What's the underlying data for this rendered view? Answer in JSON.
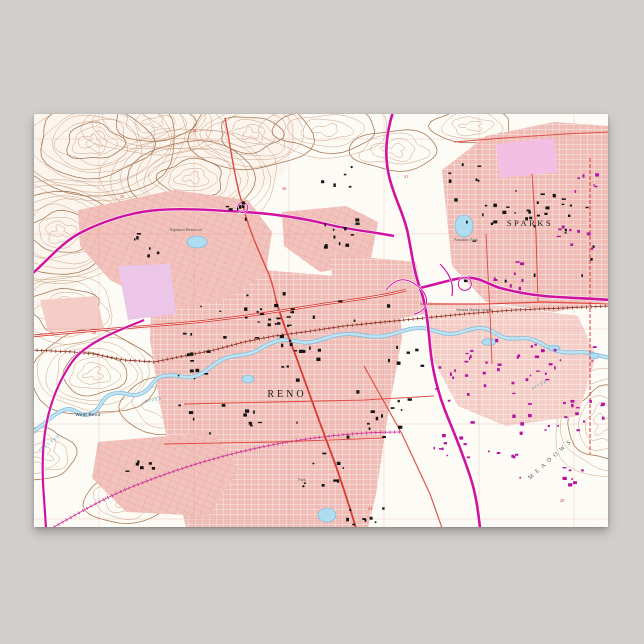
{
  "scene": {
    "background_color": "#d1cfcc",
    "poster_paper_color": "#fdfbf6"
  },
  "palette": {
    "contour": "#c59877",
    "contour_dark": "#a87b58",
    "terrain_wash": "#f9f1e7",
    "urban_pink": "#efbcb6",
    "urban_pink_light": "#f4cdc6",
    "lavender": "#ecc6e8",
    "lavender2": "#f4bfe4",
    "highway_magenta": "#cf12a0",
    "road_red": "#df4a42",
    "road_red_bold": "#d93a32",
    "rail_brown": "#8a2a1e",
    "rail_magenta": "#cc2a96",
    "water_edge": "#7db9d9",
    "water_fill": "#bfe3f2",
    "pond_fill": "#aedcf0",
    "pond_edge": "#74b4d4",
    "building_black": "#141414",
    "building_purple": "#b016a0",
    "section_line_red": "#e89088",
    "section_number_red": "#e03030",
    "label_black": "#1a1a1a",
    "label_gray": "#555555",
    "label_blue": "#4aa0c8"
  },
  "map": {
    "labels": [
      {
        "id": "reno",
        "text": "RENO",
        "x": 253,
        "y": 283,
        "size": 10,
        "spacing": 3,
        "fill": "#1a1a1a",
        "font": "serif",
        "rotate": 0,
        "italic": false
      },
      {
        "id": "sparks",
        "text": "SPARKS",
        "x": 496,
        "y": 112,
        "size": 8.5,
        "spacing": 2.5,
        "fill": "#1a1a1a",
        "font": "serif",
        "rotate": 0,
        "italic": false
      },
      {
        "id": "west-reno",
        "text": "West Reno",
        "x": 54,
        "y": 302,
        "size": 4.5,
        "spacing": 0.3,
        "fill": "#222222",
        "font": "sans",
        "rotate": 0,
        "italic": false
      },
      {
        "id": "meadows",
        "text": "MEADOWS",
        "x": 518,
        "y": 346,
        "size": 6,
        "spacing": 4,
        "fill": "#555555",
        "font": "serif",
        "rotate": -42,
        "italic": false
      },
      {
        "id": "truckee-river-w",
        "text": "TRUCKEE",
        "x": 16,
        "y": 330,
        "size": 4,
        "spacing": 1.2,
        "fill": "#4aa0c8",
        "font": "serif",
        "rotate": -38,
        "italic": true
      },
      {
        "id": "river-w",
        "text": "RIVER",
        "x": 120,
        "y": 287,
        "size": 4,
        "spacing": 1.2,
        "fill": "#4aa0c8",
        "font": "serif",
        "rotate": -12,
        "italic": true
      },
      {
        "id": "river-e",
        "text": "RIVER",
        "x": 506,
        "y": 272,
        "size": 4,
        "spacing": 1.2,
        "fill": "#4aa0c8",
        "font": "serif",
        "rotate": -28,
        "italic": true
      },
      {
        "id": "highland-reservoir",
        "text": "Highland Reservoir",
        "x": 152,
        "y": 117,
        "size": 3.4,
        "spacing": 0.2,
        "fill": "#444444",
        "font": "sans",
        "rotate": 0,
        "italic": false
      },
      {
        "id": "paradise-park",
        "text": "Paradise Park",
        "x": 432,
        "y": 127,
        "size": 3.4,
        "spacing": 0.2,
        "fill": "#444444",
        "font": "sans",
        "rotate": 0,
        "italic": false
      },
      {
        "id": "nevada-mental-health",
        "text": "Nevada Mental Health",
        "x": 440,
        "y": 197,
        "size": 3.2,
        "spacing": 0.2,
        "fill": "#444444",
        "font": "sans",
        "rotate": 0,
        "italic": false
      },
      {
        "id": "park",
        "text": "Park",
        "x": 268,
        "y": 367,
        "size": 3.4,
        "spacing": 0.2,
        "fill": "#444444",
        "font": "sans",
        "rotate": 0,
        "italic": false
      }
    ],
    "section_numbers": [
      {
        "text": "35",
        "x": 88,
        "y": 84
      },
      {
        "text": "36",
        "x": 250,
        "y": 76
      },
      {
        "text": "31",
        "x": 372,
        "y": 64
      },
      {
        "text": "30",
        "x": 160,
        "y": 18
      },
      {
        "text": "28",
        "x": 60,
        "y": 220
      },
      {
        "text": "24",
        "x": 336,
        "y": 396
      },
      {
        "text": "20",
        "x": 528,
        "y": 388
      }
    ],
    "terrain_wash_path": "M 0,0 L 270,0 L 250,60 L 200,90 L 120,110 L 60,160 L 0,200 Z",
    "hills": [
      {
        "cx": 60,
        "cy": 28,
        "rx": 92,
        "ry": 58,
        "rings": 13
      },
      {
        "cx": 158,
        "cy": 64,
        "rx": 88,
        "ry": 50,
        "rings": 11
      },
      {
        "cx": 26,
        "cy": 118,
        "rx": 72,
        "ry": 52,
        "rings": 10
      },
      {
        "cx": 216,
        "cy": 20,
        "rx": 62,
        "ry": 36,
        "rings": 8
      },
      {
        "cx": 120,
        "cy": 8,
        "rx": 70,
        "ry": 34,
        "rings": 7
      },
      {
        "cx": 60,
        "cy": 260,
        "rx": 64,
        "ry": 42,
        "rings": 8
      },
      {
        "cx": 140,
        "cy": 292,
        "rx": 56,
        "ry": 28,
        "rings": 4
      },
      {
        "cx": 30,
        "cy": 196,
        "rx": 50,
        "ry": 34,
        "rings": 6
      },
      {
        "cx": 292,
        "cy": 16,
        "rx": 64,
        "ry": 26,
        "rings": 5
      },
      {
        "cx": 360,
        "cy": 36,
        "rx": 44,
        "ry": 20,
        "rings": 4
      },
      {
        "cx": 438,
        "cy": 12,
        "rx": 40,
        "ry": 18,
        "rings": 4
      },
      {
        "cx": 568,
        "cy": 310,
        "rx": 48,
        "ry": 54,
        "rings": 6
      },
      {
        "cx": 90,
        "cy": 386,
        "rx": 40,
        "ry": 24,
        "rings": 4
      },
      {
        "cx": 10,
        "cy": 340,
        "rx": 30,
        "ry": 26,
        "rings": 4
      }
    ],
    "urban_areas": [
      {
        "id": "downtown-reno",
        "path": "M 118,166 L 205,154 L 300,162 L 345,170 L 366,190 L 368,224 L 354,300 L 342,380 L 334,414 L 152,414 L 140,360 L 126,290 L 116,226 Z",
        "fill": "#efbcb6",
        "grid": "gridWhite"
      },
      {
        "id": "northwest-residential",
        "path": "M 44,96 L 140,76 L 214,86 L 238,118 L 232,158 L 196,184 L 136,196 L 76,166 L 46,132 Z",
        "fill": "#f2c3bd",
        "grid": "gridFine"
      },
      {
        "id": "north-central",
        "path": "M 248,98 L 312,92 L 344,108 L 336,150 L 286,158 L 250,132 Z",
        "fill": "#f2c3bd",
        "grid": "gridFine"
      },
      {
        "id": "university-district",
        "path": "M 296,140 L 382,148 L 392,200 L 334,210 L 300,182 Z",
        "fill": "#efbcb6",
        "grid": "gridWhite"
      },
      {
        "id": "sparks-urban",
        "path": "M 408,56 L 452,22 L 520,8 L 574,12 L 574,188 L 520,198 L 452,188 L 418,152 Z",
        "fill": "#efbcb6",
        "grid": "gridWhite"
      },
      {
        "id": "glendale-east",
        "path": "M 388,188 L 470,192 L 544,202 L 562,242 L 544,302 L 472,312 L 424,292 L 398,244 Z",
        "fill": "#f4cdc6",
        "grid": "gridWhite"
      },
      {
        "id": "southwest-residential",
        "path": "M 64,328 L 180,318 L 204,356 L 174,402 L 92,398 L 58,364 Z",
        "fill": "#f2c3bd",
        "grid": "gridFine"
      },
      {
        "id": "riverfront-patch",
        "path": "M 6,186 L 62,182 L 70,214 L 14,218 Z",
        "fill": "#f4cdc6",
        "grid": null
      },
      {
        "id": "lavender-west",
        "path": "M 84,152 L 136,150 L 142,200 L 94,206 Z",
        "fill": "#ecc6e8",
        "grid": null
      },
      {
        "id": "lavender-sparks",
        "path": "M 462,30 L 520,24 L 524,58 L 466,64 Z",
        "fill": "#f4bfe4",
        "grid": null
      }
    ],
    "section_lines": {
      "xs": [
        65,
        160,
        255,
        350,
        445,
        540
      ],
      "ys": [
        25,
        120,
        215,
        310,
        405
      ]
    },
    "river": {
      "name": "Truckee River",
      "path": "M -2,318 C 10,312 18,300 30,296 C 42,292 44,304 56,300 C 68,296 66,284 78,280 C 90,276 96,284 106,280 C 118,276 118,264 130,262 C 144,259 150,266 162,262 C 174,258 180,248 192,244 C 204,240 214,242 224,236 C 234,230 242,226 252,226 C 262,226 268,230 278,228 C 292,225 300,220 314,220 C 328,220 336,224 350,222 C 364,220 372,214 386,214 C 398,214 404,220 416,220 C 428,220 434,214 446,214 C 458,214 462,222 472,224 C 482,226 490,222 500,226 C 510,230 516,236 528,238 C 540,240 548,236 558,240 L 576,244"
    },
    "ponds": [
      {
        "id": "virginia-lake",
        "cx": 293,
        "cy": 401,
        "rx": 9,
        "ry": 7
      },
      {
        "id": "paradise-pond",
        "cx": 430,
        "cy": 112,
        "rx": 9,
        "ry": 11
      },
      {
        "id": "idlewild-pond",
        "cx": 214,
        "cy": 265,
        "rx": 6,
        "ry": 4
      },
      {
        "id": "highland-reservoir-pond",
        "cx": 163,
        "cy": 128,
        "rx": 10,
        "ry": 6
      },
      {
        "id": "oxbow-1",
        "cx": 455,
        "cy": 228,
        "rx": 7,
        "ry": 3.5
      },
      {
        "id": "oxbow-2",
        "cx": 520,
        "cy": 234,
        "rx": 6,
        "ry": 3
      },
      {
        "id": "oxbow-3",
        "cx": 560,
        "cy": 242,
        "rx": 5,
        "ry": 3
      }
    ],
    "railroads": [
      {
        "id": "sp-mainline",
        "color": "#8a2a1e",
        "path": "M -2,236 L 40,238 L 60,240 L 90,246 L 120,248 L 150,242 L 180,236 L 210,228 L 240,222 L 270,218 L 310,212 L 350,208 L 390,204 L 430,200 L 480,196 L 530,194 L 576,192"
      },
      {
        "id": "wp-branch",
        "color": "#cc2a96",
        "path": "M 20,413 C 50,396 70,384 100,372 C 130,360 160,350 190,342 C 220,334 250,328 280,324 C 310,320 340,318 366,318"
      }
    ],
    "highways": [
      {
        "id": "us-395",
        "width": 2.6,
        "path": "M 359,-2 C 352,20 350,44 356,66 C 362,88 370,100 374,120 C 378,140 380,158 386,174 C 392,190 394,210 396,232 C 398,254 404,280 414,304 C 424,328 430,344 436,362 C 442,380 444,396 446,414"
      },
      {
        "id": "i-80-east",
        "width": 2.6,
        "path": "M 386,174 C 404,170 414,166 428,164 C 446,162 452,170 466,174 C 482,178 492,180 510,182 C 530,184 552,184 576,186"
      },
      {
        "id": "us-40-northwest",
        "width": 2.4,
        "path": "M -2,160 C 14,146 28,128 48,118 C 68,108 96,98 124,96 C 148,94 178,96 211,98 C 244,100 268,104 292,110 C 316,116 340,118 360,122"
      },
      {
        "id": "southwest-highway",
        "width": 2.2,
        "path": "M 110,206 C 86,216 52,228 38,248 C 24,268 16,290 12,312 C 8,334 8,360 10,384 L 12,414"
      },
      {
        "id": "ramp-1",
        "width": 1,
        "path": "M 386,174 C 370,160 360,166 352,176"
      },
      {
        "id": "ramp-2",
        "width": 1,
        "path": "M 386,174 C 398,186 392,198 380,200"
      },
      {
        "id": "ramp-loop-east",
        "width": 1,
        "path": "M 428,164 a 6.5,6.5 0 1 1 -0.2,0.1"
      },
      {
        "id": "ramp-loop-nw",
        "width": 1,
        "path": "M 211,98 a 5,5 0 1 0 -0.2,0.1"
      },
      {
        "id": "sparks-spur",
        "width": 1.2,
        "path": "M 406,150 C 416,160 420,170 418,182"
      }
    ],
    "roads": [
      {
        "id": "north-virginia-st",
        "color": "#df4a42",
        "width": 1.4,
        "double": false,
        "dash": null,
        "path": "M 191,4 C 196,30 200,60 206,82 C 209,92 210,94 211,99 C 216,118 226,140 234,158 C 238,168 240,176 242,186"
      },
      {
        "id": "south-virginia-st",
        "color": "#d93a32",
        "width": 1.8,
        "double": false,
        "dash": null,
        "path": "M 242,186 C 248,208 256,226 264,248 C 274,276 284,304 296,336 C 306,362 314,388 322,414"
      },
      {
        "id": "i-80-west-red",
        "color": "#d93a32",
        "width": 2.6,
        "double": true,
        "dash": null,
        "path": "M -2,222 C 40,218 90,214 140,210 C 190,206 240,198 290,190 C 320,186 350,182 372,176"
      },
      {
        "id": "b-street-sparks",
        "color": "#df4a42",
        "width": 1.2,
        "double": false,
        "dash": null,
        "path": "M 386,190 L 450,190 L 510,188 L 576,190"
      },
      {
        "id": "pyramid-way",
        "color": "#df4a42",
        "width": 1,
        "double": false,
        "dash": null,
        "path": "M 498,60 L 502,120 L 504,188"
      },
      {
        "id": "rock-blvd",
        "color": "#df4a42",
        "width": 0.9,
        "double": false,
        "dash": null,
        "path": "M 452,120 L 456,200 L 458,250"
      },
      {
        "id": "mill-st",
        "color": "#df4a42",
        "width": 0.9,
        "double": false,
        "dash": null,
        "path": "M 150,290 L 240,288 L 330,286 L 400,282"
      },
      {
        "id": "second-st",
        "color": "#df4a42",
        "width": 0.9,
        "double": false,
        "dash": null,
        "path": "M 130,330 L 240,328 L 350,324"
      },
      {
        "id": "kietzke-lane",
        "color": "#df4a42",
        "width": 1.1,
        "double": false,
        "dash": null,
        "path": "M 330,252 L 368,320 L 396,380 L 408,414"
      },
      {
        "id": "city-boundary-dashed",
        "color": "#e03838",
        "width": 1,
        "double": false,
        "dash": "4,2",
        "path": "M 556,44 L 556,200 L 556,340"
      },
      {
        "id": "north-sparks-road",
        "color": "#df4a42",
        "width": 0.9,
        "double": false,
        "dash": null,
        "path": "M 420,28 L 470,24 L 530,20 L 576,18"
      }
    ],
    "building_clusters": [
      {
        "cx": 234,
        "cy": 206,
        "n": 18,
        "spread": 26,
        "color": "#141414"
      },
      {
        "cx": 306,
        "cy": 118,
        "n": 12,
        "spread": 20,
        "color": "#141414"
      },
      {
        "cx": 196,
        "cy": 96,
        "n": 7,
        "spread": 16,
        "color": "#141414"
      },
      {
        "cx": 262,
        "cy": 238,
        "n": 10,
        "spread": 22,
        "color": "#141414"
      },
      {
        "cx": 286,
        "cy": 356,
        "n": 9,
        "spread": 26,
        "color": "#141414"
      },
      {
        "cx": 208,
        "cy": 300,
        "n": 7,
        "spread": 22,
        "color": "#141414"
      },
      {
        "cx": 350,
        "cy": 298,
        "n": 8,
        "spread": 24,
        "color": "#141414"
      },
      {
        "cx": 104,
        "cy": 352,
        "n": 6,
        "spread": 18,
        "color": "#141414"
      },
      {
        "cx": 332,
        "cy": 396,
        "n": 8,
        "spread": 20,
        "color": "#141414"
      },
      {
        "cx": 478,
        "cy": 104,
        "n": 10,
        "spread": 22,
        "color": "#141414"
      },
      {
        "cx": 520,
        "cy": 90,
        "n": 8,
        "spread": 18,
        "color": "#141414"
      },
      {
        "cx": 300,
        "cy": 60,
        "n": 5,
        "spread": 18,
        "color": "#141414"
      },
      {
        "cx": 120,
        "cy": 130,
        "n": 6,
        "spread": 20,
        "color": "#141414"
      },
      {
        "cx": 160,
        "cy": 250,
        "n": 6,
        "spread": 20,
        "color": "#141414"
      },
      {
        "cx": 370,
        "cy": 240,
        "n": 6,
        "spread": 18,
        "color": "#141414"
      },
      {
        "cx": 430,
        "cy": 60,
        "n": 6,
        "spread": 16,
        "color": "#141414"
      },
      {
        "cx": 250,
        "cy": 250,
        "n": 30,
        "spread": 110,
        "color": "#161616"
      },
      {
        "cx": 490,
        "cy": 120,
        "n": 20,
        "spread": 70,
        "color": "#161616"
      },
      {
        "cx": 438,
        "cy": 250,
        "n": 12,
        "spread": 26,
        "color": "#b016a0"
      },
      {
        "cx": 504,
        "cy": 252,
        "n": 14,
        "spread": 28,
        "color": "#b016a0"
      },
      {
        "cx": 548,
        "cy": 298,
        "n": 10,
        "spread": 20,
        "color": "#b016a0"
      },
      {
        "cx": 472,
        "cy": 160,
        "n": 8,
        "spread": 20,
        "color": "#b016a0"
      },
      {
        "cx": 540,
        "cy": 124,
        "n": 8,
        "spread": 18,
        "color": "#b016a0"
      },
      {
        "cx": 556,
        "cy": 66,
        "n": 6,
        "spread": 16,
        "color": "#b016a0"
      },
      {
        "cx": 416,
        "cy": 330,
        "n": 8,
        "spread": 18,
        "color": "#b016a0"
      },
      {
        "cx": 470,
        "cy": 350,
        "n": 8,
        "spread": 22,
        "color": "#b016a0"
      },
      {
        "cx": 540,
        "cy": 360,
        "n": 7,
        "spread": 18,
        "color": "#b016a0"
      },
      {
        "cx": 480,
        "cy": 280,
        "n": 24,
        "spread": 80,
        "color": "#b016a0"
      }
    ]
  }
}
